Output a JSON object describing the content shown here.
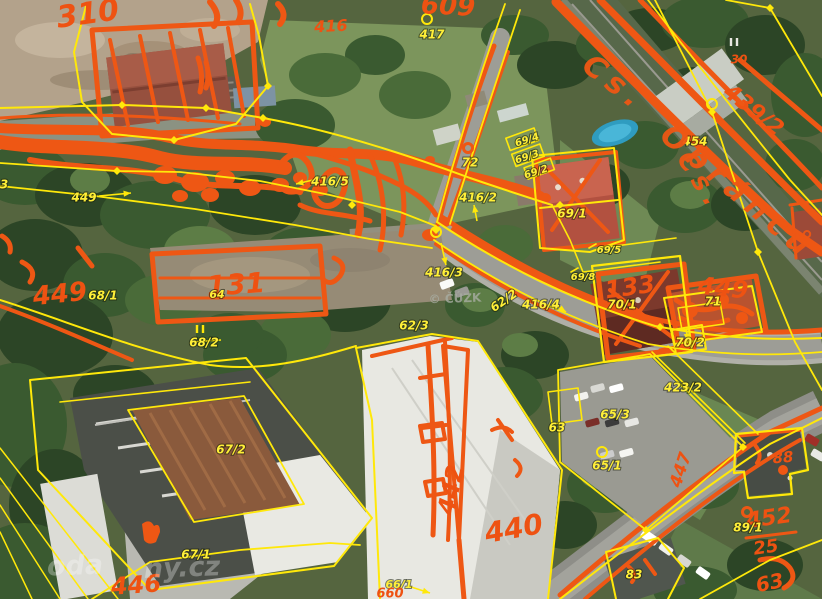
{
  "map": {
    "type": "cadastral-orthophoto-overlay",
    "colors": {
      "sketch_orange": "#ee5714",
      "boundary_yellow": "#ffe80a",
      "label_yellow": "#ffef38",
      "watermark_gray": "#a8ada2"
    },
    "watermarks": {
      "center": "© ČÚZK",
      "corner_fragments": [
        "oda",
        "ny.cz"
      ]
    },
    "labels": [
      {
        "text": "310",
        "x": 88,
        "y": 15,
        "rot": -8,
        "size": 30,
        "kind": "o"
      },
      {
        "text": "609",
        "x": 448,
        "y": 7,
        "rot": 3,
        "size": 26,
        "kind": "o"
      },
      {
        "text": "416",
        "x": 331,
        "y": 27,
        "rot": -3,
        "size": 16,
        "kind": "o"
      },
      {
        "text": "417",
        "x": 432,
        "y": 35,
        "rot": 0,
        "size": 12,
        "kind": "y"
      },
      {
        "text": "30",
        "x": 739,
        "y": 60,
        "rot": 0,
        "size": 12,
        "kind": "o"
      },
      {
        "text": "439/2",
        "x": 753,
        "y": 111,
        "rot": 38,
        "size": 22,
        "kind": "o"
      },
      {
        "text": "454",
        "x": 695,
        "y": 142,
        "rot": 0,
        "size": 12,
        "kind": "y"
      },
      {
        "text": "69/4",
        "x": 527,
        "y": 140,
        "rot": -18,
        "size": 10,
        "kind": "y"
      },
      {
        "text": "69/3",
        "x": 527,
        "y": 157,
        "rot": -18,
        "size": 10,
        "kind": "y"
      },
      {
        "text": "69/2",
        "x": 536,
        "y": 172,
        "rot": -18,
        "size": 10,
        "kind": "y"
      },
      {
        "text": "72",
        "x": 470,
        "y": 163,
        "rot": 0,
        "size": 12,
        "kind": "y"
      },
      {
        "text": "416/2",
        "x": 478,
        "y": 198,
        "rot": 0,
        "size": 12,
        "kind": "y"
      },
      {
        "text": "69/1",
        "x": 572,
        "y": 214,
        "rot": 0,
        "size": 12,
        "kind": "y"
      },
      {
        "text": "449",
        "x": 84,
        "y": 198,
        "rot": 0,
        "size": 12,
        "kind": "y"
      },
      {
        "text": "3",
        "x": 4,
        "y": 185,
        "rot": 0,
        "size": 12,
        "kind": "y"
      },
      {
        "text": "449",
        "x": 60,
        "y": 295,
        "rot": -6,
        "size": 26,
        "kind": "o"
      },
      {
        "text": "68/1",
        "x": 103,
        "y": 296,
        "rot": 0,
        "size": 12,
        "kind": "y"
      },
      {
        "text": "131",
        "x": 236,
        "y": 286,
        "rot": -4,
        "size": 28,
        "kind": "o"
      },
      {
        "text": "64",
        "x": 217,
        "y": 295,
        "rot": 0,
        "size": 11,
        "kind": "y"
      },
      {
        "text": "68/2",
        "x": 204,
        "y": 343,
        "rot": 0,
        "size": 12,
        "kind": "y"
      },
      {
        "text": "416/5",
        "x": 330,
        "y": 182,
        "rot": 0,
        "size": 12,
        "kind": "y"
      },
      {
        "text": "416/3",
        "x": 444,
        "y": 273,
        "rot": 0,
        "size": 12,
        "kind": "y"
      },
      {
        "text": "62/3",
        "x": 414,
        "y": 326,
        "rot": 0,
        "size": 12,
        "kind": "y"
      },
      {
        "text": "62/2",
        "x": 504,
        "y": 301,
        "rot": -35,
        "size": 12,
        "kind": "y"
      },
      {
        "text": "416/4",
        "x": 541,
        "y": 305,
        "rot": 0,
        "size": 12,
        "kind": "y"
      },
      {
        "text": "© ČÚZK",
        "x": 455,
        "y": 299,
        "rot": -2,
        "size": 12,
        "kind": "gray"
      },
      {
        "text": "69/5",
        "x": 609,
        "y": 250,
        "rot": 0,
        "size": 10,
        "kind": "y"
      },
      {
        "text": "69/8",
        "x": 583,
        "y": 277,
        "rot": 0,
        "size": 10,
        "kind": "y"
      },
      {
        "text": "133",
        "x": 630,
        "y": 288,
        "rot": -8,
        "size": 24,
        "kind": "o"
      },
      {
        "text": "449",
        "x": 723,
        "y": 289,
        "rot": 6,
        "size": 24,
        "kind": "o"
      },
      {
        "text": "70/1",
        "x": 622,
        "y": 305,
        "rot": 0,
        "size": 12,
        "kind": "y"
      },
      {
        "text": "71",
        "x": 713,
        "y": 302,
        "rot": 0,
        "size": 12,
        "kind": "y"
      },
      {
        "text": "70/2",
        "x": 690,
        "y": 343,
        "rot": 0,
        "size": 12,
        "kind": "y"
      },
      {
        "text": "423/2",
        "x": 683,
        "y": 388,
        "rot": 0,
        "size": 12,
        "kind": "y"
      },
      {
        "text": "65/3",
        "x": 615,
        "y": 415,
        "rot": 0,
        "size": 12,
        "kind": "y"
      },
      {
        "text": "63",
        "x": 557,
        "y": 428,
        "rot": 0,
        "size": 12,
        "kind": "y"
      },
      {
        "text": "65/1",
        "x": 607,
        "y": 466,
        "rot": 0,
        "size": 12,
        "kind": "y"
      },
      {
        "text": "88",
        "x": 783,
        "y": 458,
        "rot": -5,
        "size": 15,
        "kind": "o"
      },
      {
        "text": "452",
        "x": 769,
        "y": 519,
        "rot": -8,
        "size": 22,
        "kind": "o"
      },
      {
        "text": "25",
        "x": 766,
        "y": 548,
        "rot": -8,
        "size": 18,
        "kind": "o"
      },
      {
        "text": "89/1",
        "x": 748,
        "y": 528,
        "rot": 0,
        "size": 12,
        "kind": "y"
      },
      {
        "text": "83",
        "x": 634,
        "y": 575,
        "rot": 0,
        "size": 12,
        "kind": "y"
      },
      {
        "text": "63",
        "x": 770,
        "y": 584,
        "rot": -12,
        "size": 20,
        "kind": "o"
      },
      {
        "text": "447",
        "x": 681,
        "y": 470,
        "rot": -72,
        "size": 17,
        "kind": "o"
      },
      {
        "text": "442",
        "x": 452,
        "y": 490,
        "rot": -78,
        "size": 24,
        "kind": "o"
      },
      {
        "text": "440",
        "x": 514,
        "y": 530,
        "rot": -10,
        "size": 28,
        "kind": "o"
      },
      {
        "text": "67/2",
        "x": 231,
        "y": 450,
        "rot": 0,
        "size": 12,
        "kind": "y"
      },
      {
        "text": "67/1",
        "x": 196,
        "y": 555,
        "rot": 0,
        "size": 12,
        "kind": "y"
      },
      {
        "text": "446",
        "x": 136,
        "y": 586,
        "rot": -4,
        "size": 24,
        "kind": "o"
      },
      {
        "text": "66/1",
        "x": 399,
        "y": 585,
        "rot": 0,
        "size": 11,
        "kind": "y"
      },
      {
        "text": "660",
        "x": 390,
        "y": 594,
        "rot": 0,
        "size": 13,
        "kind": "o"
      },
      {
        "text": "Čs.",
        "x": 614,
        "y": 84,
        "rot": 38,
        "size": 30,
        "kind": "street"
      },
      {
        "text": "Obránců",
        "x": 737,
        "y": 193,
        "rot": 40,
        "size": 30,
        "kind": "street"
      },
      {
        "text": "Čs.",
        "x": 700,
        "y": 182,
        "rot": 58,
        "size": 26,
        "kind": "street"
      },
      {
        "text": "oda",
        "x": 75,
        "y": 567,
        "rot": -2,
        "size": 27,
        "kind": "wm"
      },
      {
        "text": "ny.cz",
        "x": 182,
        "y": 569,
        "rot": -2,
        "size": 27,
        "kind": "wm"
      }
    ],
    "overlay": {
      "vertex_diamonds": [
        [
          122,
          105
        ],
        [
          206,
          108
        ],
        [
          263,
          118
        ],
        [
          117,
          171
        ],
        [
          352,
          205
        ],
        [
          436,
          230
        ],
        [
          660,
          327
        ],
        [
          712,
          112
        ],
        [
          758,
          252
        ],
        [
          770,
          8
        ],
        [
          743,
          447
        ],
        [
          646,
          530
        ],
        [
          268,
          86
        ],
        [
          174,
          140
        ],
        [
          560,
          205
        ]
      ],
      "circles_yellow": [
        [
          602,
          452
        ],
        [
          427,
          19
        ],
        [
          712,
          104
        ],
        [
          436,
          232
        ]
      ],
      "circles_orange": [
        [
          468,
          148
        ],
        [
          747,
          512
        ]
      ],
      "arrows": [
        [
          99,
          196,
          131,
          193
        ],
        [
          477,
          221,
          474,
          205
        ],
        [
          441,
          243,
          446,
          265
        ],
        [
          313,
          180,
          296,
          184
        ],
        [
          554,
          304,
          566,
          312
        ],
        [
          686,
          329,
          688,
          341
        ],
        [
          408,
          586,
          430,
          593
        ]
      ],
      "double_ticks": [
        [
          200,
          329,
          "#ffe80a"
        ],
        [
          734,
          42,
          "#e8e8e2"
        ]
      ],
      "strikes": [
        [
          190,
          342,
          221,
          340
        ]
      ]
    }
  }
}
